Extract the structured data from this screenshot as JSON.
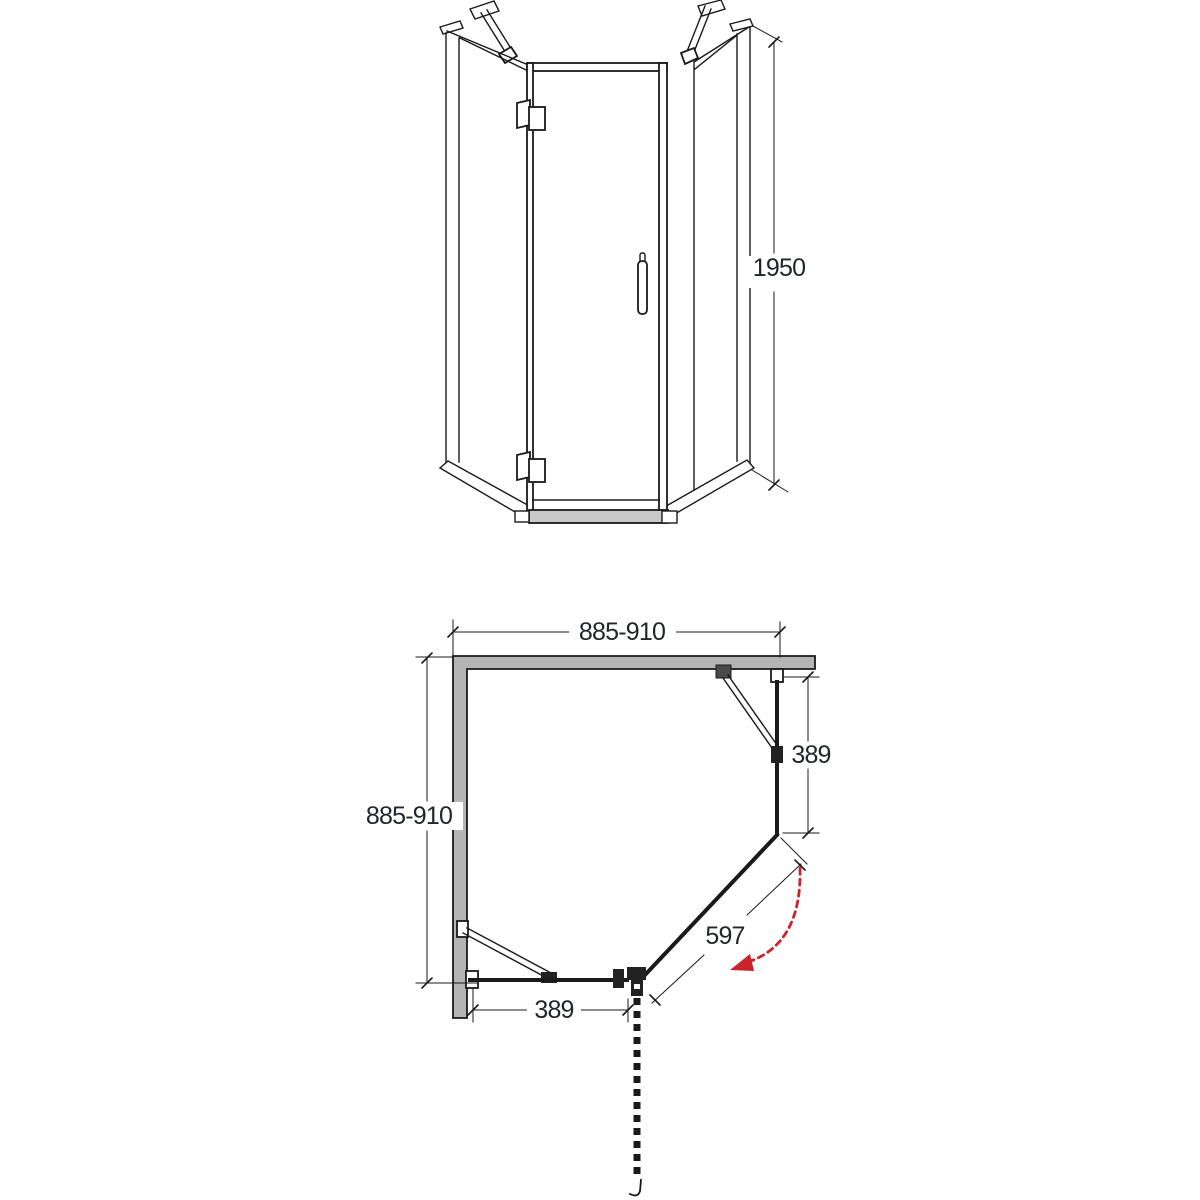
{
  "diagram": {
    "title": "pentagon-shower-enclosure-technical-drawing",
    "front_view": {
      "height_label": "1950"
    },
    "plan_view": {
      "width_label": "885-910",
      "depth_label": "885-910",
      "right_panel_label": "389",
      "bottom_panel_label": "389",
      "door_label": "597"
    }
  },
  "colors": {
    "line_color": "#1a1a1a",
    "wall_fill": "#b4b4b4",
    "label_color": "#20262c",
    "swing_color": "#cc2229",
    "rail_fill": "#c9c9c9",
    "page_bg": "#ffffff"
  }
}
